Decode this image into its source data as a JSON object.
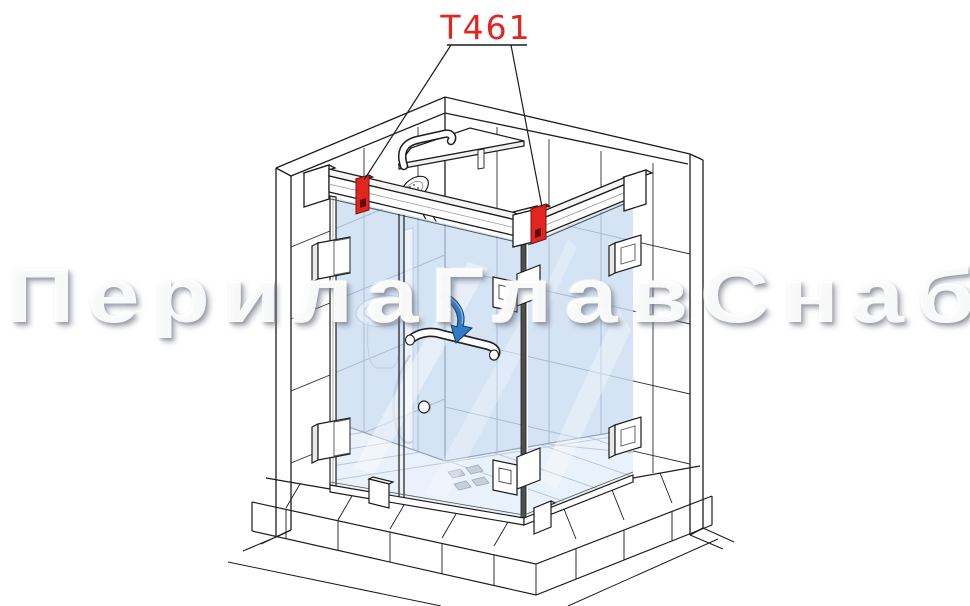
{
  "label": {
    "part_code": "T461"
  },
  "watermark": {
    "text": "ПерилаГлавСнаб"
  },
  "colors": {
    "accent_red": "#e2251f",
    "dark_red": "#8f1512",
    "screw_red": "#5f0d10",
    "glass_blue": "#d5e4f5",
    "floor_blue": "#e9f1fa",
    "arrow_blue": "#2f7cc6",
    "line_dark": "#1c1c1c",
    "line_interior": "#a9bcd4"
  }
}
